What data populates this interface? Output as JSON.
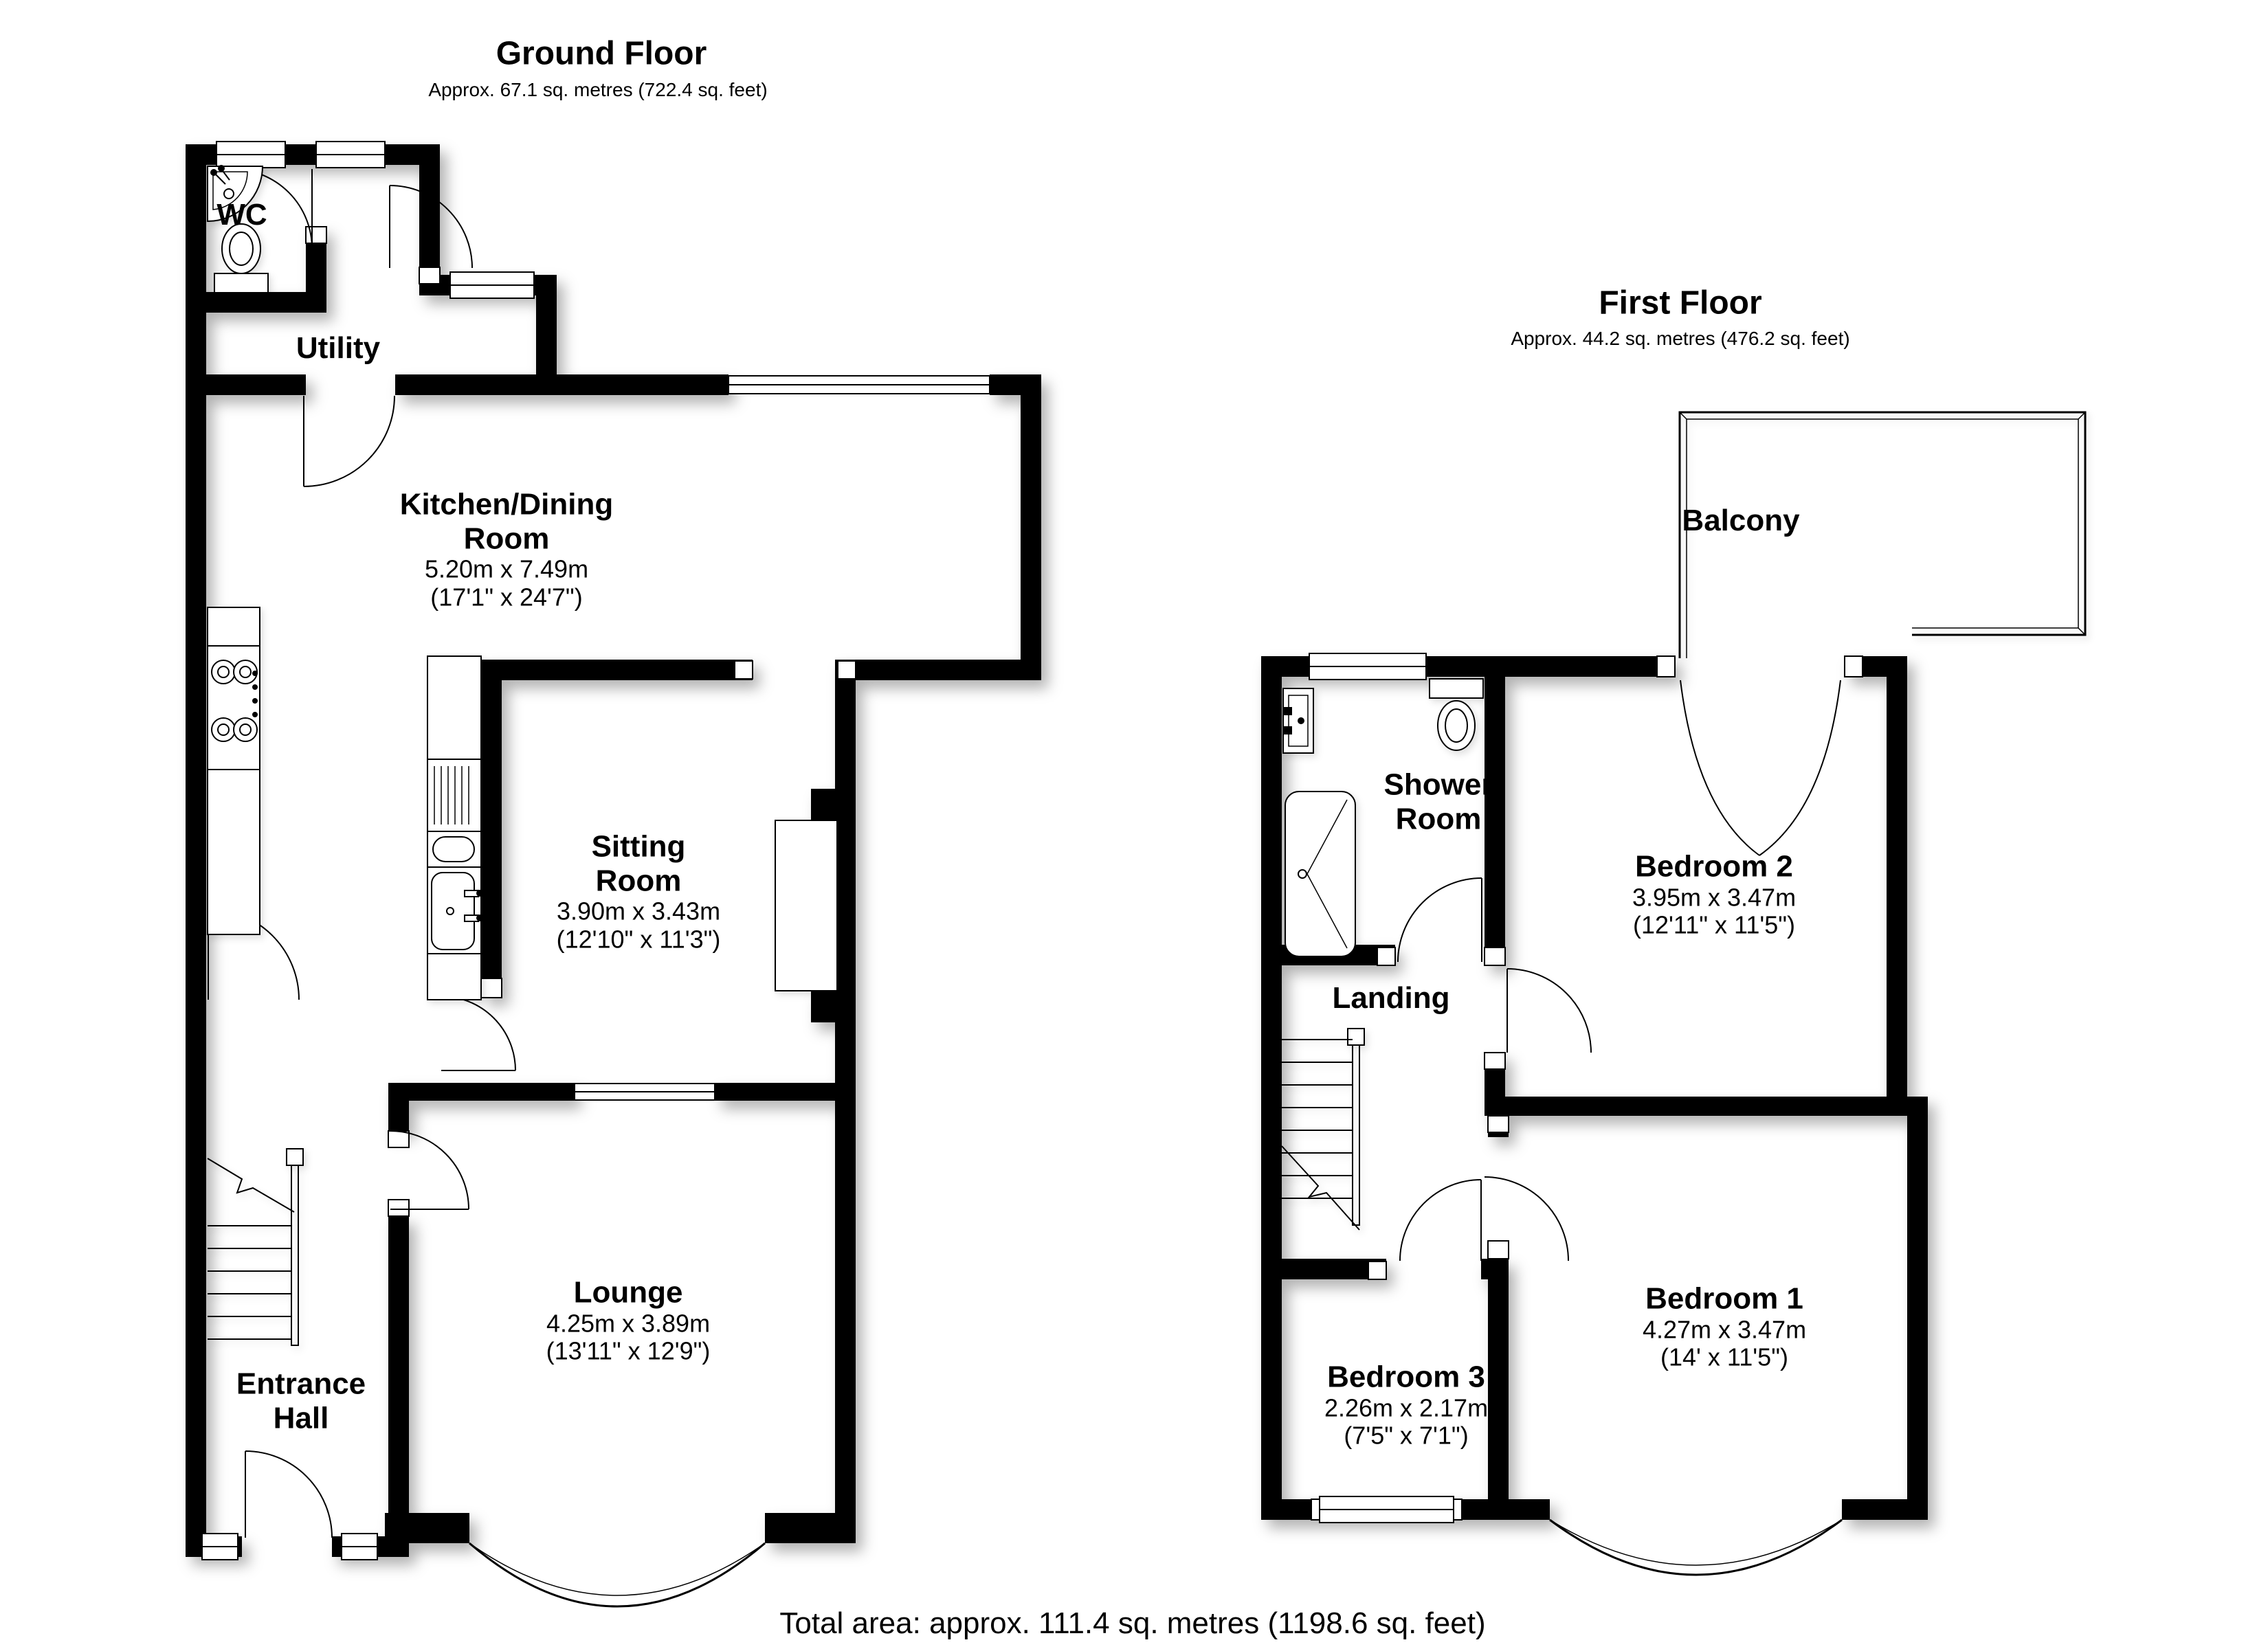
{
  "colors": {
    "wall": "#000000",
    "background": "#ffffff",
    "text": "#000000"
  },
  "ground_floor": {
    "title": "Ground Floor",
    "subtitle": "Approx. 67.1 sq. metres (722.4 sq. feet)",
    "rooms": {
      "wc": {
        "name": "WC"
      },
      "utility": {
        "name": "Utility"
      },
      "kitchen": {
        "name": "Kitchen/Dining Room",
        "metric": "5.20m x 7.49m",
        "imperial": "(17'1\" x 24'7\")"
      },
      "sitting": {
        "name": "Sitting Room",
        "metric": "3.90m x 3.43m",
        "imperial": "(12'10\" x 11'3\")"
      },
      "lounge": {
        "name": "Lounge",
        "metric": "4.25m x 3.89m",
        "imperial": "(13'11\" x 12'9\")"
      },
      "entrance": {
        "name": "Entrance Hall"
      }
    }
  },
  "first_floor": {
    "title": "First Floor",
    "subtitle": "Approx. 44.2 sq. metres (476.2 sq. feet)",
    "rooms": {
      "balcony": {
        "name": "Balcony"
      },
      "shower": {
        "name": "Shower Room"
      },
      "bedroom2": {
        "name": "Bedroom 2",
        "metric": "3.95m x 3.47m",
        "imperial": "(12'11\" x 11'5\")"
      },
      "landing": {
        "name": "Landing"
      },
      "bedroom3": {
        "name": "Bedroom 3",
        "metric": "2.26m x 2.17m",
        "imperial": "(7'5\" x 7'1\")"
      },
      "bedroom1": {
        "name": "Bedroom 1",
        "metric": "4.27m x 3.47m",
        "imperial": "(14' x 11'5\")"
      }
    }
  },
  "footer": {
    "total_area": "Total area: approx. 111.4 sq. metres (1198.6 sq. feet)"
  },
  "fixtures_visible": [
    "corner-sink",
    "toilet",
    "hob",
    "kitchen-sink",
    "stairs",
    "basin",
    "shower-tray",
    "bay-window",
    "balcony"
  ]
}
